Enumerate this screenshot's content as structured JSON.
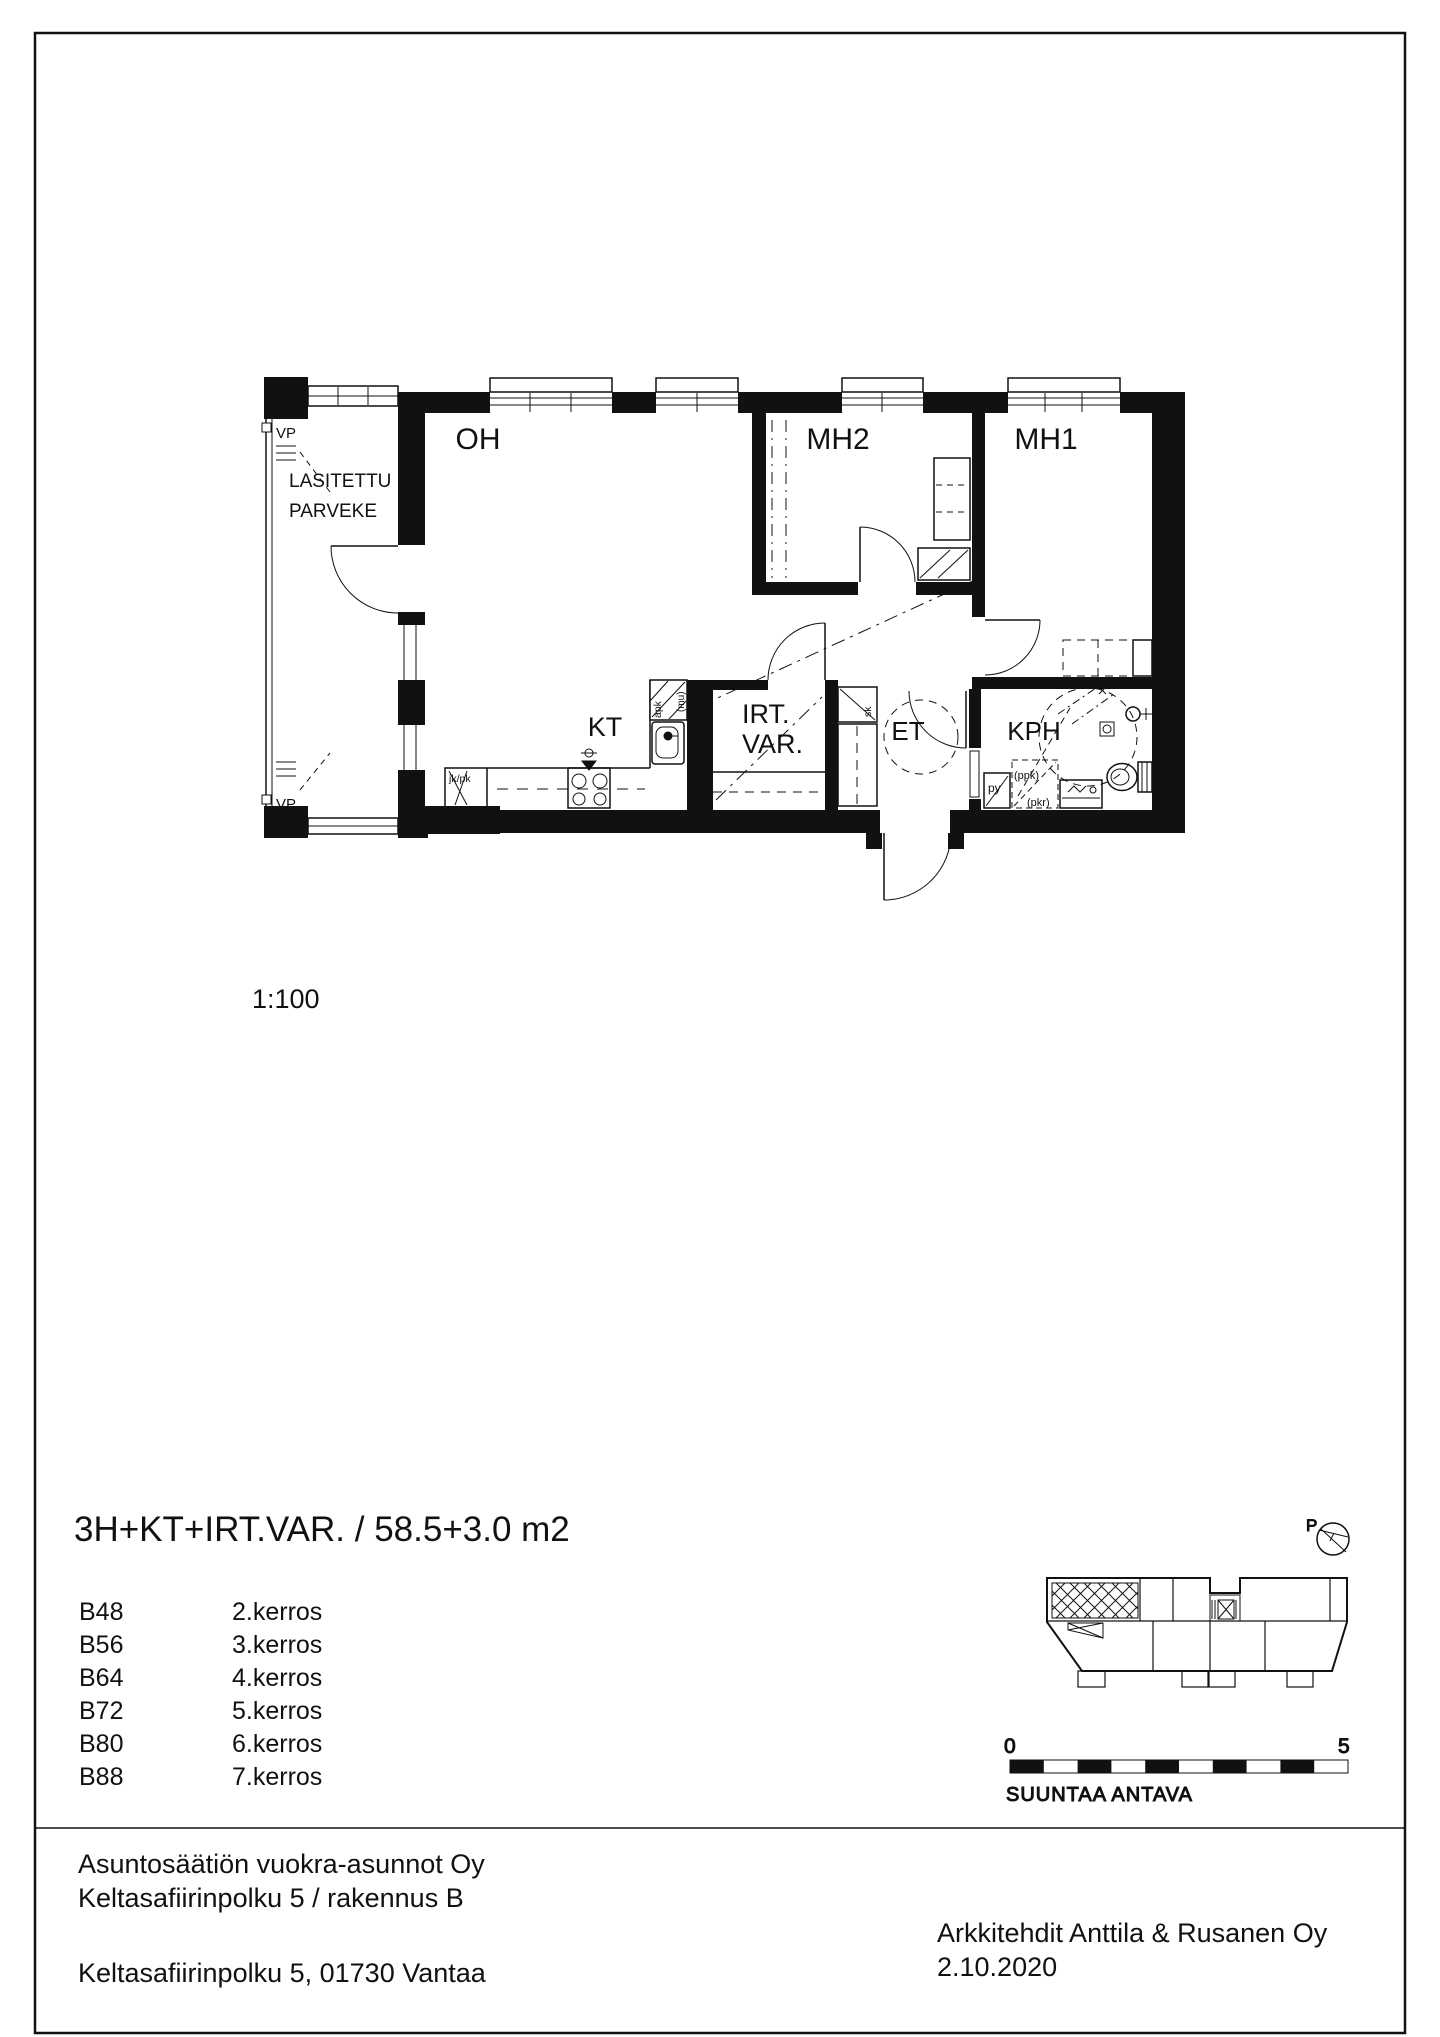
{
  "document": {
    "scale_label": "1:100",
    "title": "3H+KT+IRT.VAR. / 58.5+3.0 m2"
  },
  "units": [
    {
      "id": "B48",
      "floor": "2.kerros"
    },
    {
      "id": "B56",
      "floor": "3.kerros"
    },
    {
      "id": "B64",
      "floor": "4.kerros"
    },
    {
      "id": "B72",
      "floor": "5.kerros"
    },
    {
      "id": "B80",
      "floor": "6.kerros"
    },
    {
      "id": "B88",
      "floor": "7.kerros"
    }
  ],
  "plan": {
    "rooms": {
      "living_room": "OH",
      "bedroom_2": "MH2",
      "bedroom_1": "MH1",
      "kitchen": "KT",
      "storage_line1": "IRT.",
      "storage_line2": "VAR.",
      "entry_hall": "ET",
      "bathroom": "KPH",
      "balcony_line1": "LASITETTU",
      "balcony_line2": "PARVEKE",
      "vent_window_top": "VP",
      "vent_window_bottom": "VP"
    },
    "fixtures": {
      "fridge_freezer": "jk/pk",
      "dishwasher": "apk",
      "microwave": "(mu)",
      "closet": "sk",
      "laundry_cabinet": "py",
      "washing_machine_reserved": "(ppk)",
      "dryer_reserved": "(pkr)"
    }
  },
  "key_plan": {
    "north_label": "P",
    "scale_zero": "0",
    "scale_five": "5",
    "note": "SUUNTAA ANTAVA"
  },
  "footer": {
    "company": "Asuntosäätiön vuokra-asunnot Oy",
    "project": "Keltasafiirinpolku 5 / rakennus B",
    "address": "Keltasafiirinpolku 5, 01730 Vantaa",
    "architect": "Arkkitehdit Anttila & Rusanen Oy",
    "date": "2.10.2020"
  },
  "colors": {
    "ink": "#111111",
    "paper": "#ffffff"
  }
}
